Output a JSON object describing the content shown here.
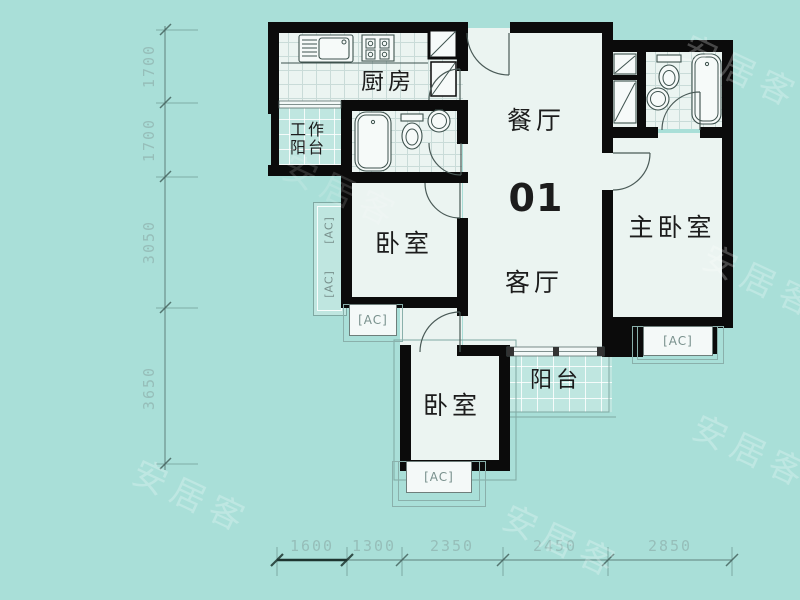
{
  "unit_number": "01",
  "rooms": {
    "kitchen": "厨房",
    "dining": "餐厅",
    "living": "客厅",
    "master_bedroom": "主卧室",
    "bedroom_left": "卧室",
    "bedroom_bottom": "卧室",
    "work_balcony": {
      "line1": "工作",
      "line2": "阳台"
    },
    "balcony": "阳台"
  },
  "ac_unit_label": "[AC]",
  "dimensions_mm": {
    "left": [
      "1700",
      "1700",
      "3050",
      "3650"
    ],
    "bottom": [
      "1600",
      "1300",
      "2350",
      "2450",
      "2850"
    ]
  },
  "watermark_text": "安居客",
  "colors": {
    "background": "#A9DFD8",
    "room_fill": "#EBF4F1",
    "balcony_fill": "#BFE6E0",
    "wall": "#0B0B0B",
    "dimension_text": "#96BEB9",
    "ac_text": "#78908C"
  }
}
